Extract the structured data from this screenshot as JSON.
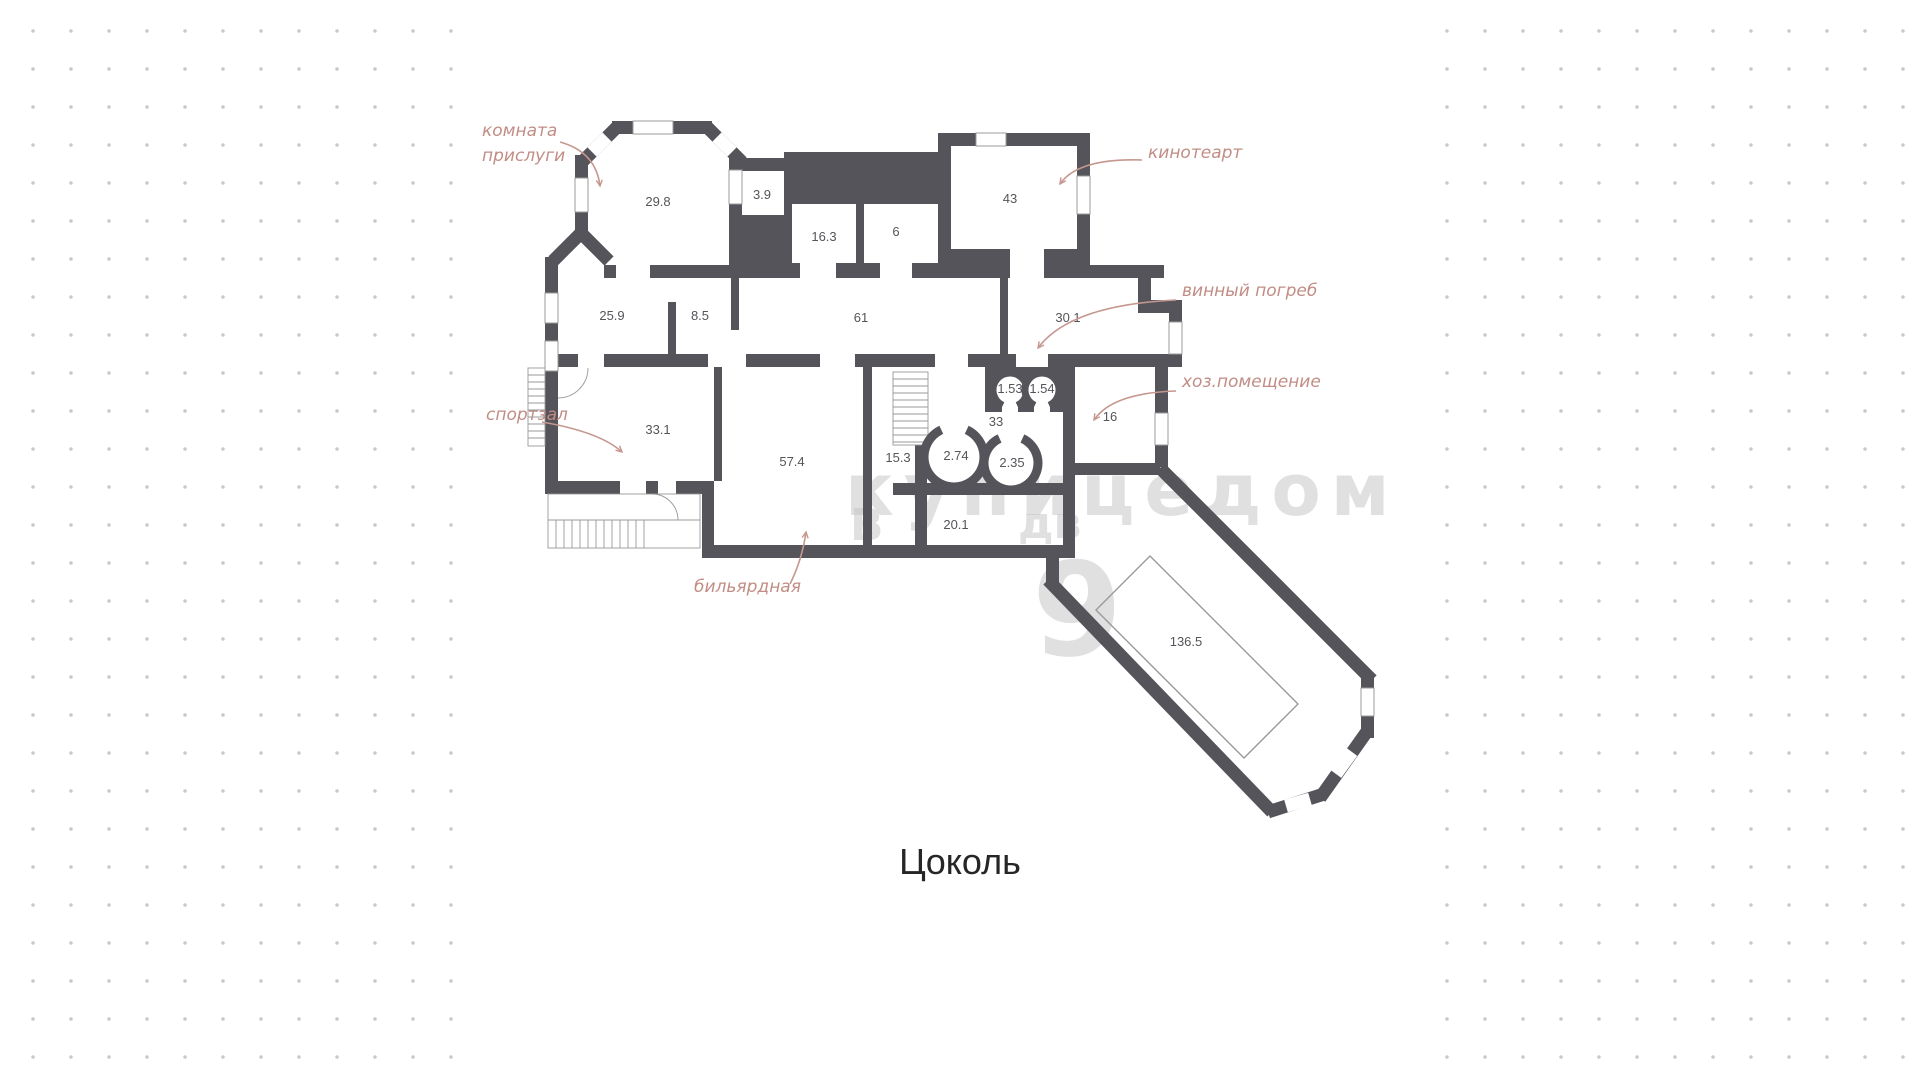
{
  "title": {
    "floor_label": "Цоколь"
  },
  "colors": {
    "wall": "#54545a",
    "annotation": "#c18d85",
    "room_number": "#55555a",
    "dots": "#c9c9c9",
    "watermark": "#c3c3c3"
  },
  "rooms": [
    {
      "area": "29.8",
      "x": 658,
      "y": 206
    },
    {
      "area": "3.9",
      "x": 762,
      "y": 199
    },
    {
      "area": "16.3",
      "x": 824,
      "y": 241
    },
    {
      "area": "6",
      "x": 896,
      "y": 236
    },
    {
      "area": "43",
      "x": 1010,
      "y": 203
    },
    {
      "area": "25.9",
      "x": 612,
      "y": 320
    },
    {
      "area": "8.5",
      "x": 700,
      "y": 320
    },
    {
      "area": "61",
      "x": 861,
      "y": 322
    },
    {
      "area": "30.1",
      "x": 1068,
      "y": 322
    },
    {
      "area": "1.53",
      "x": 1010,
      "y": 393
    },
    {
      "area": "1.54",
      "x": 1042,
      "y": 393
    },
    {
      "area": "33",
      "x": 996,
      "y": 426
    },
    {
      "area": "16",
      "x": 1110,
      "y": 421
    },
    {
      "area": "33.1",
      "x": 658,
      "y": 434
    },
    {
      "area": "57.4",
      "x": 792,
      "y": 466
    },
    {
      "area": "15.3",
      "x": 898,
      "y": 462
    },
    {
      "area": "2.74",
      "x": 956,
      "y": 460
    },
    {
      "area": "2.35",
      "x": 1012,
      "y": 467
    },
    {
      "area": "20.1",
      "x": 956,
      "y": 529
    },
    {
      "area": "136.5",
      "x": 1186,
      "y": 646
    }
  ],
  "annotations": [
    {
      "id": "komnata-prislugi",
      "lines": [
        "комната",
        "прислуги"
      ],
      "x": 482,
      "y": 136,
      "arrow": "M560 142 Q596 152 600 186"
    },
    {
      "id": "kinoteart",
      "lines": [
        "кинотеарт"
      ],
      "x": 1148,
      "y": 158,
      "arrow": "M1142 160 Q1078 158 1060 184"
    },
    {
      "id": "vinny-pogreb",
      "lines": [
        "винный погреб"
      ],
      "x": 1182,
      "y": 296,
      "arrow": "M1176 300 Q1070 305 1038 348"
    },
    {
      "id": "hozpomeshchenie",
      "lines": [
        "хоз.помещение"
      ],
      "x": 1182,
      "y": 387,
      "arrow": "M1176 391 Q1112 393 1094 420"
    },
    {
      "id": "sportzal",
      "lines": [
        "спортзал"
      ],
      "x": 486,
      "y": 420,
      "arrow": "M542 422 Q600 432 622 452"
    },
    {
      "id": "bilyardnaya",
      "lines": [
        "бильярдная"
      ],
      "x": 694,
      "y": 592,
      "arrow": "M790 584 Q802 560 806 532"
    }
  ],
  "watermark": {
    "word": "купицедом",
    "fragments": [
      {
        "t": "В",
        "x": 850,
        "y": 540,
        "s": 44
      },
      {
        "t": "дв",
        "x": 1018,
        "y": 538,
        "s": 44
      },
      {
        "t": "9",
        "x": 1032,
        "y": 655,
        "s": 130
      }
    ]
  }
}
